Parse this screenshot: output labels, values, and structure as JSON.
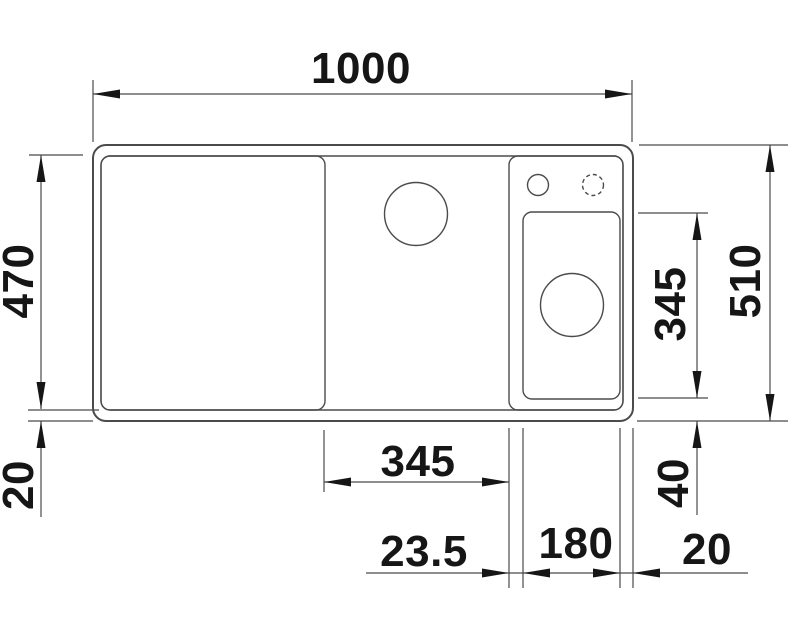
{
  "figure": {
    "kind": "sink-technical-dimension-drawing",
    "view": "top",
    "background_color": "#ffffff",
    "line_color": "#4b4b4b",
    "text_color": "#161616"
  },
  "dimensions": {
    "overall_width": "1000",
    "overall_depth": "510",
    "basin_depth": "470",
    "rim_bottom_offset": "20",
    "main_bowl_width": "345",
    "half_bowl_depth": "345",
    "bowl_divider_gap": "23.5",
    "half_bowl_width": "180",
    "rim_right_offset": "20",
    "half_bowl_rear_offset": "40"
  }
}
